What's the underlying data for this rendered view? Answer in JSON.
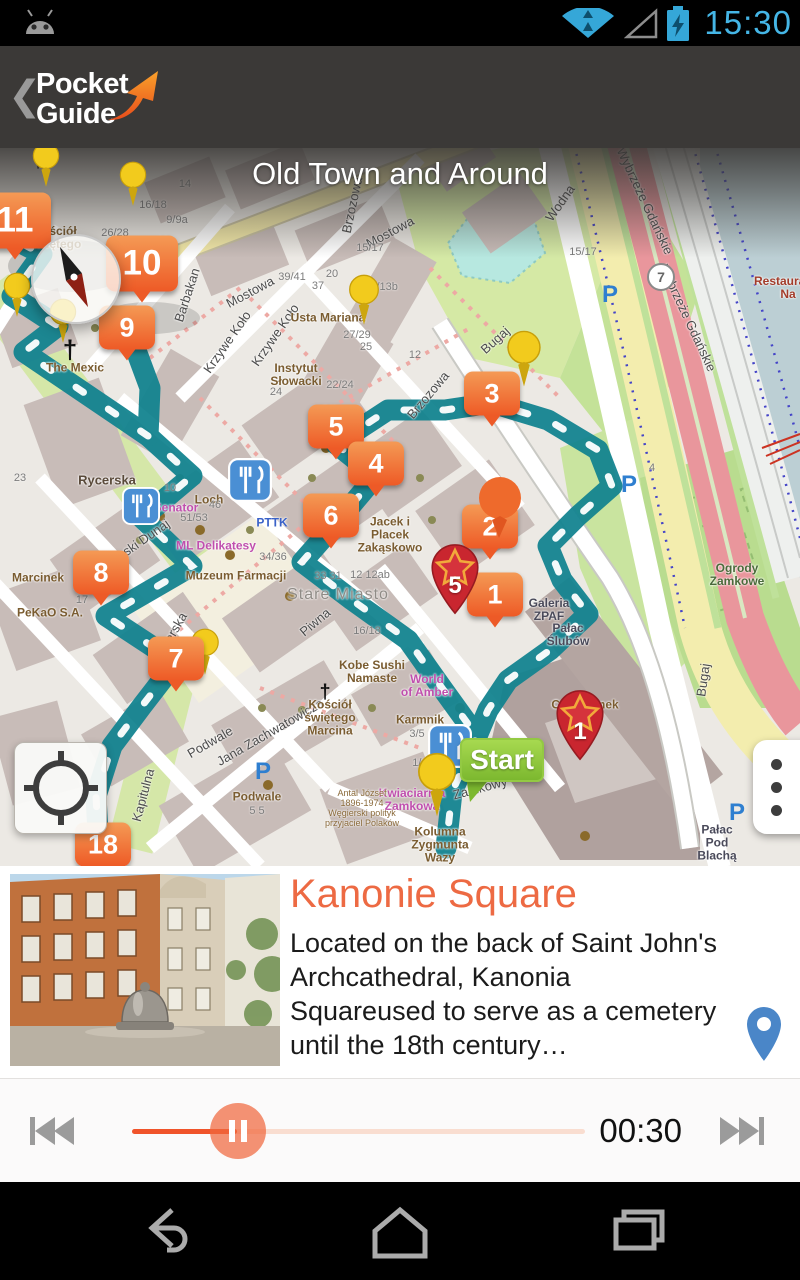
{
  "status_bar": {
    "time": "15:30"
  },
  "header": {
    "back_glyph": "❮",
    "app_name_line1": "Pocket",
    "app_name_line2": "Guide"
  },
  "map": {
    "title": "Old Town and Around",
    "start_label": "Start",
    "parking_label": "P",
    "route_badge": "7",
    "cross_glyph": "†",
    "tour_markers": [
      "11",
      "10",
      "9",
      "8",
      "7",
      "18",
      "5",
      "4",
      "6",
      "3",
      "2",
      "1"
    ],
    "star_markers": [
      "5",
      "1"
    ],
    "street_labels": [
      "Mostowa",
      "Mostowa",
      "Brzozowa",
      "Brzozowa",
      "Wodna",
      "Bugaj",
      "Bugaj",
      "Wybrzeże Gdańskie",
      "Wybrzeże Gdańskie",
      "Barbakan",
      "Krzywe Koło",
      "Krzywe Koło",
      "Wąski Dunaj",
      "Piwna",
      "Podwale",
      "Kapitulna",
      "Jana Zachwatowicza",
      "Rycerska",
      "Rycerska",
      "Zamkowy",
      "Stare Miasto"
    ],
    "poi_labels": [
      "Kościół\nŚwiętego",
      "The Mexic",
      "Usta Mariana",
      "Instytut\nSłowacki",
      "Jacek i\nPlacek\nZakąskowo",
      "Muzeum Farmacji",
      "Marcinek",
      "PeKaO S.A.",
      "Loch",
      "Senator",
      "ML Delikatesy",
      "PTTK",
      "Kobe Sushi\nNamaste",
      "Kościół\nświętego\nMarcina",
      "World\nof Amber",
      "Karmnik",
      "Café Zamek",
      "Galeria\nZPAF",
      "Pałac\nŚlubów",
      "Ogrody\nZamkowe",
      "Pałac\nPod\nBlachą",
      "Kolumna\nZygmunta\nWazy",
      "Kwiaciarnia\nZamkowa",
      "Restauracja\nNa",
      "Podwale",
      "Antal József\n1896-1974\nWęgierski polityk\nprzyjaciel Polaków"
    ],
    "house_numbers": [
      "16/18",
      "14",
      "26/28",
      "23/25",
      "9/9a",
      "11",
      "15/17",
      "15/17",
      "13a/13b",
      "39/41",
      "37",
      "20",
      "27/29",
      "25",
      "22/24",
      "24",
      "5/9",
      "1/3",
      "33 31",
      "12 12ab",
      "16/18",
      "51/53",
      "34/36",
      "46",
      "3/5",
      "1/13",
      "17",
      "23",
      "12",
      "10",
      "4",
      "5  5"
    ]
  },
  "poi_card": {
    "title": "Kanonie Square",
    "description": "Located on the back of Saint John's Archcathedral, Kanonia Squareused to serve as a cemetery until the 18th century…"
  },
  "player": {
    "elapsed": "00:30"
  }
}
